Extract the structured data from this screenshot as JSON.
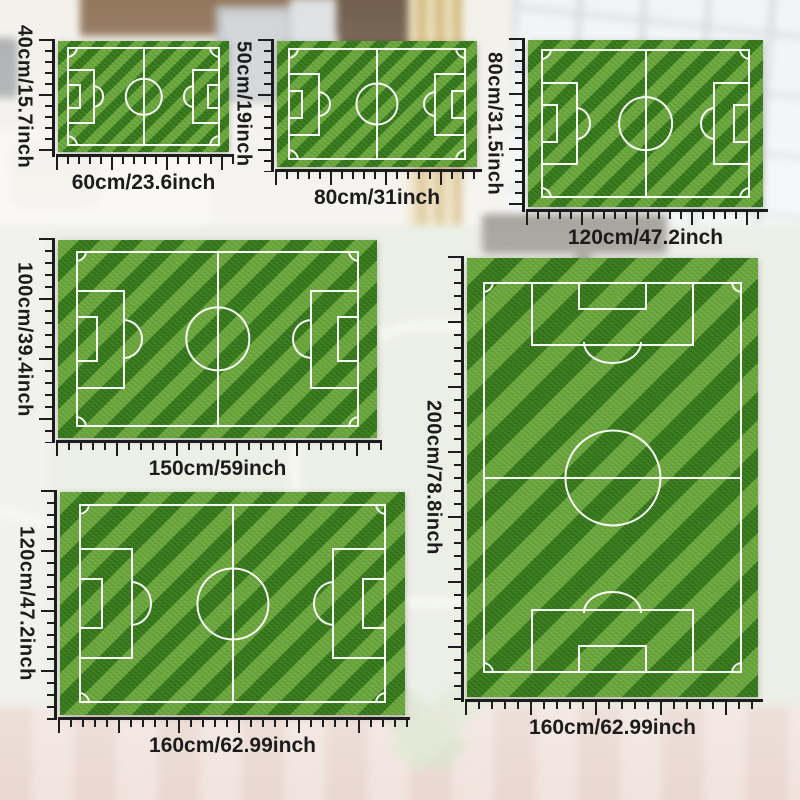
{
  "product": {
    "name": "soccer-field-rug-size-chart",
    "variant_count": 6
  },
  "sizes": [
    {
      "height_label": "40cm/15.7inch",
      "width_label": "60cm/23.6inch",
      "orientation": "landscape"
    },
    {
      "height_label": "50cm/19inch",
      "width_label": "80cm/31inch",
      "orientation": "landscape"
    },
    {
      "height_label": "80cm/31.5inch",
      "width_label": "120cm/47.2inch",
      "orientation": "landscape"
    },
    {
      "height_label": "100cm/39.4inch",
      "width_label": "150cm/59inch",
      "orientation": "landscape"
    },
    {
      "height_label": "120cm/47.2inch",
      "width_label": "160cm/62.99inch",
      "orientation": "landscape"
    },
    {
      "height_label": "200cm/78.8inch",
      "width_label": "160cm/62.99inch",
      "orientation": "portrait"
    }
  ],
  "colors": {
    "grass_base": "#418a21",
    "grass_stripe_light": "#5ca832",
    "grass_stripe_dark": "#35761a",
    "field_line": "#ffffff",
    "ruler": "#1d1d1d",
    "label_text": "#1c1c1c"
  }
}
